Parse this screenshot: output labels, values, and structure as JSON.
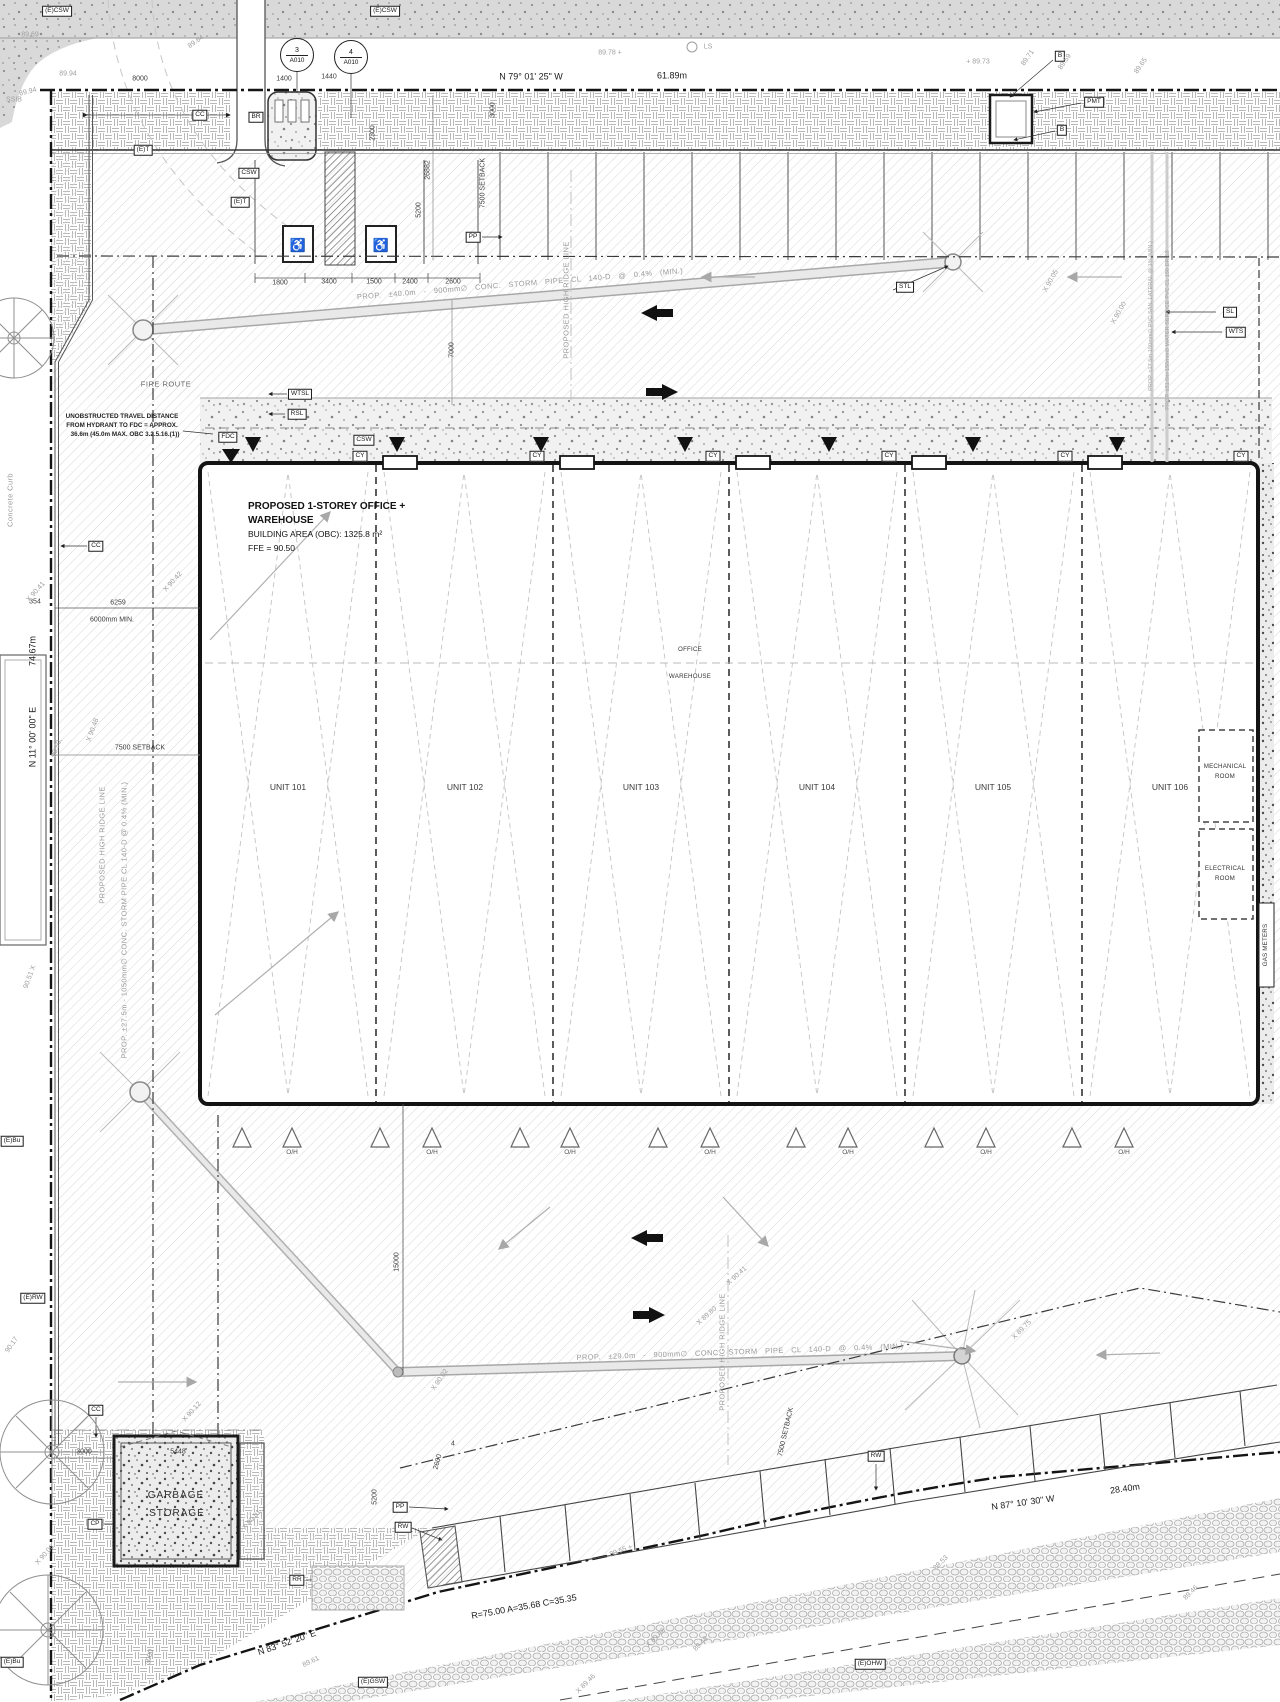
{
  "drawing": {
    "building": {
      "title_line1": "PROPOSED 1-STOREY OFFICE +",
      "title_line2": "WAREHOUSE",
      "area": "BUILDING AREA (OBC): 1325.8 m²",
      "ffe": "FFE = 90.50"
    },
    "bubbles": [
      {
        "name": "detail-bubble-3",
        "num": "3",
        "sheet": "A010",
        "x": 297,
        "y": 55
      },
      {
        "name": "detail-bubble-4",
        "num": "4",
        "sheet": "A010",
        "x": 351,
        "y": 57
      }
    ],
    "labels": [
      {
        "n": "tag-ecsw-1",
        "t": "(E)CSW",
        "x": 57,
        "y": 11,
        "c": "box"
      },
      {
        "n": "tag-ecsw-2",
        "t": "(E)CSW",
        "x": 385,
        "y": 11,
        "c": "box"
      },
      {
        "n": "tag-et-1",
        "t": "(E)T",
        "x": 143,
        "y": 150,
        "c": "box"
      },
      {
        "n": "tag-et-2",
        "t": "(E)T",
        "x": 240,
        "y": 202,
        "c": "box"
      },
      {
        "n": "tag-cc-1",
        "t": "CC",
        "x": 200,
        "y": 115,
        "c": "box"
      },
      {
        "n": "tag-br",
        "t": "BR",
        "x": 256,
        "y": 117,
        "c": "box"
      },
      {
        "n": "tag-csw-1",
        "t": "CSW",
        "x": 249,
        "y": 173,
        "c": "box"
      },
      {
        "n": "tag-cc-2",
        "t": "CC",
        "x": 96,
        "y": 546,
        "c": "box"
      },
      {
        "n": "tag-wtsl",
        "t": "WTSL",
        "x": 300,
        "y": 394,
        "c": "box"
      },
      {
        "n": "tag-rsl",
        "t": "RSL",
        "x": 297,
        "y": 414,
        "c": "box"
      },
      {
        "n": "tag-fdc",
        "t": "FDC",
        "x": 228,
        "y": 437,
        "c": "box"
      },
      {
        "n": "tag-csw-2",
        "t": "CSW",
        "x": 364,
        "y": 440,
        "c": "box"
      },
      {
        "n": "tag-pp-1",
        "t": "PP",
        "x": 473,
        "y": 237,
        "c": "box"
      },
      {
        "n": "tag-stl",
        "t": "STL",
        "x": 905,
        "y": 287,
        "c": "box"
      },
      {
        "n": "tag-sl",
        "t": "SL",
        "x": 1230,
        "y": 312,
        "c": "box"
      },
      {
        "n": "tag-wts",
        "t": "WTS",
        "x": 1236,
        "y": 332,
        "c": "box"
      },
      {
        "n": "tag-b-1",
        "t": "B",
        "x": 1060,
        "y": 56,
        "c": "box"
      },
      {
        "n": "tag-pmt",
        "t": "PMT",
        "x": 1094,
        "y": 102,
        "c": "box"
      },
      {
        "n": "tag-b-2",
        "t": "B",
        "x": 1062,
        "y": 130,
        "c": "box"
      },
      {
        "n": "tag-cy-1",
        "t": "CY",
        "x": 360,
        "y": 456,
        "c": "box"
      },
      {
        "n": "tag-cy-2",
        "t": "CY",
        "x": 537,
        "y": 456,
        "c": "box"
      },
      {
        "n": "tag-cy-3",
        "t": "CY",
        "x": 713,
        "y": 456,
        "c": "box"
      },
      {
        "n": "tag-cy-4",
        "t": "CY",
        "x": 889,
        "y": 456,
        "c": "box"
      },
      {
        "n": "tag-cy-5",
        "t": "CY",
        "x": 1065,
        "y": 456,
        "c": "box"
      },
      {
        "n": "tag-cy-6",
        "t": "CY",
        "x": 1241,
        "y": 456,
        "c": "box"
      },
      {
        "n": "tag-erw",
        "t": "(E)RW",
        "x": 33,
        "y": 1298,
        "c": "box"
      },
      {
        "n": "tag-cc-3",
        "t": "CC",
        "x": 96,
        "y": 1410,
        "c": "box"
      },
      {
        "n": "tag-cp",
        "t": "CP",
        "x": 95,
        "y": 1524,
        "c": "box"
      },
      {
        "n": "tag-rr",
        "t": "RR",
        "x": 297,
        "y": 1580,
        "c": "box"
      },
      {
        "n": "tag-pp-2",
        "t": "PP",
        "x": 400,
        "y": 1507,
        "c": "box"
      },
      {
        "n": "tag-rw-1",
        "t": "RW",
        "x": 403,
        "y": 1527,
        "c": "box"
      },
      {
        "n": "tag-rw-2",
        "t": "RW",
        "x": 876,
        "y": 1456,
        "c": "box"
      },
      {
        "n": "tag-egsw",
        "t": "(E)GSW",
        "x": 373,
        "y": 1682,
        "c": "box"
      },
      {
        "n": "tag-eohw",
        "t": "(E)OHW",
        "x": 870,
        "y": 1664,
        "c": "box"
      },
      {
        "n": "tag-ebu-1",
        "t": "(E)Bu",
        "x": 12,
        "y": 1141,
        "c": "box"
      },
      {
        "n": "tag-ebu-2",
        "t": "(E)Bu",
        "x": 12,
        "y": 1662,
        "c": "box"
      },
      {
        "n": "bearing-north",
        "t": "N 79° 01' 25\" W",
        "x": 531,
        "y": 77,
        "c": "bear"
      },
      {
        "n": "length-north",
        "t": "61.89m",
        "x": 672,
        "y": 76,
        "c": "bear"
      },
      {
        "n": "length-west",
        "t": "74.67m",
        "x": 33,
        "y": 651,
        "r": -90,
        "c": "bear"
      },
      {
        "n": "bearing-west",
        "t": "N 11° 00' 00\" E",
        "x": 33,
        "y": 737,
        "r": -90,
        "c": "bear"
      },
      {
        "n": "bearing-south",
        "t": "N 83° 52' 20\" E",
        "x": 287,
        "y": 1643,
        "r": -19,
        "c": "bear"
      },
      {
        "n": "curve-data",
        "t": "R=75.00 A=35.68 C=35.35",
        "x": 524,
        "y": 1607,
        "r": -10,
        "c": "bear"
      },
      {
        "n": "bearing-southeast",
        "t": "N 87° 10' 30\" W",
        "x": 1023,
        "y": 1503,
        "r": -8,
        "c": "bear"
      },
      {
        "n": "length-southeast",
        "t": "28.40m",
        "x": 1125,
        "y": 1489,
        "r": -8,
        "c": "bear"
      },
      {
        "n": "dim-8000",
        "t": "8000",
        "x": 140,
        "y": 79,
        "c": "dim"
      },
      {
        "n": "dim-1400",
        "t": "1400",
        "x": 284,
        "y": 79,
        "c": "dim"
      },
      {
        "n": "dim-1440",
        "t": "1440",
        "x": 329,
        "y": 77,
        "c": "dim"
      },
      {
        "n": "dim-2300",
        "t": "2300",
        "x": 373,
        "y": 133,
        "r": -90,
        "c": "dim"
      },
      {
        "n": "dim-3000-a",
        "t": "3000",
        "x": 493,
        "y": 110,
        "r": -90,
        "c": "dim"
      },
      {
        "n": "dim-26882",
        "t": "26882",
        "x": 428,
        "y": 170,
        "r": -90,
        "c": "dim"
      },
      {
        "n": "dim-5200-a",
        "t": "5200",
        "x": 419,
        "y": 210,
        "r": -90,
        "c": "dim"
      },
      {
        "n": "dim-setback-a",
        "t": "7500 SETBACK",
        "x": 483,
        "y": 183,
        "r": -90,
        "c": "dim"
      },
      {
        "n": "dim-1800",
        "t": "1800",
        "x": 280,
        "y": 283,
        "c": "dim"
      },
      {
        "n": "dim-3400",
        "t": "3400",
        "x": 329,
        "y": 282,
        "c": "dim"
      },
      {
        "n": "dim-1500",
        "t": "1500",
        "x": 374,
        "y": 282,
        "c": "dim"
      },
      {
        "n": "dim-2400",
        "t": "2400",
        "x": 410,
        "y": 282,
        "c": "dim"
      },
      {
        "n": "dim-2600-a",
        "t": "2600",
        "x": 453,
        "y": 282,
        "c": "dim"
      },
      {
        "n": "dim-7000",
        "t": "7000",
        "x": 452,
        "y": 350,
        "r": -90,
        "c": "dim"
      },
      {
        "n": "dim-354",
        "t": "354",
        "x": 35,
        "y": 602,
        "c": "dim"
      },
      {
        "n": "dim-6259",
        "t": "6259",
        "x": 118,
        "y": 603,
        "c": "dim"
      },
      {
        "n": "dim-6000",
        "t": "6000mm MIN.",
        "x": 112,
        "y": 620,
        "c": "dim"
      },
      {
        "n": "dim-setback-b",
        "t": "7500 SETBACK",
        "x": 140,
        "y": 748,
        "c": "dim"
      },
      {
        "n": "dim-15000",
        "t": "15000",
        "x": 397,
        "y": 1262,
        "r": -90,
        "c": "dim"
      },
      {
        "n": "dim-2600-b",
        "t": "2600",
        "x": 438,
        "y": 1462,
        "r": -75,
        "c": "dim"
      },
      {
        "n": "dim-4",
        "t": "4",
        "x": 453,
        "y": 1444,
        "c": "dim"
      },
      {
        "n": "dim-5200-b",
        "t": "5200",
        "x": 375,
        "y": 1497,
        "r": -90,
        "c": "dim"
      },
      {
        "n": "dim-3000-b",
        "t": "3000",
        "x": 84,
        "y": 1452,
        "c": "dim"
      },
      {
        "n": "dim-5448",
        "t": "5448",
        "x": 178,
        "y": 1452,
        "c": "dim"
      },
      {
        "n": "dim-3000-c",
        "t": "3000",
        "x": 150,
        "y": 1657,
        "r": -78,
        "c": "dimg"
      },
      {
        "n": "dim-setback-c",
        "t": "7500 SETBACK",
        "x": 786,
        "y": 1432,
        "r": -77,
        "c": "dim"
      },
      {
        "n": "spot-8969",
        "t": "89.69",
        "x": 30,
        "y": 35,
        "c": "spot"
      },
      {
        "n": "spot-8994-a",
        "t": "89.94",
        "x": 68,
        "y": 74,
        "c": "spot"
      },
      {
        "n": "spot-8994-b",
        "t": "89.94",
        "x": 28,
        "y": 92,
        "r": -15,
        "c": "spot"
      },
      {
        "n": "spot-8964",
        "t": "89.64",
        "x": 196,
        "y": 42,
        "r": -35,
        "c": "spot"
      },
      {
        "n": "spot-ssib",
        "t": "SSIB",
        "x": 14,
        "y": 100,
        "c": "spot"
      },
      {
        "n": "spot-8978",
        "t": "89.78  +",
        "x": 610,
        "y": 53,
        "c": "spot"
      },
      {
        "n": "spot-ls",
        "t": "LS",
        "x": 708,
        "y": 47,
        "c": "spot"
      },
      {
        "n": "spot-8973",
        "t": "+ 89.73",
        "x": 978,
        "y": 62,
        "c": "spot"
      },
      {
        "n": "spot-8971",
        "t": "89.71",
        "x": 1028,
        "y": 58,
        "r": -55,
        "c": "spot"
      },
      {
        "n": "spot-8959",
        "t": "89.59",
        "x": 1065,
        "y": 62,
        "r": -55,
        "c": "spot"
      },
      {
        "n": "spot-8965",
        "t": "89.65",
        "x": 1141,
        "y": 66,
        "r": -55,
        "c": "spot"
      },
      {
        "n": "spot-9041-a",
        "t": "X 90.41",
        "x": 36,
        "y": 592,
        "r": -48,
        "c": "spot"
      },
      {
        "n": "spot-9042",
        "t": "X 90.42",
        "x": 173,
        "y": 582,
        "r": -48,
        "c": "spot"
      },
      {
        "n": "spot-9048",
        "t": "X 90.48",
        "x": 93,
        "y": 730,
        "r": -70,
        "c": "spot"
      },
      {
        "n": "spot-9050",
        "t": "90.50,",
        "x": 57,
        "y": 748,
        "r": -70,
        "c": "spot"
      },
      {
        "n": "spot-9051",
        "t": "90.51 X",
        "x": 30,
        "y": 977,
        "r": -70,
        "c": "spot"
      },
      {
        "n": "spot-9017",
        "t": "90.17",
        "x": 12,
        "y": 1345,
        "r": -55,
        "c": "spot"
      },
      {
        "n": "spot-9006",
        "t": "X 90.06",
        "x": 45,
        "y": 1555,
        "r": -48,
        "c": "spot"
      },
      {
        "n": "spot-9012",
        "t": "X 90.12",
        "x": 192,
        "y": 1412,
        "r": -48,
        "c": "spot"
      },
      {
        "n": "spot-9002",
        "t": "X 90.02",
        "x": 440,
        "y": 1380,
        "r": -55,
        "c": "spot"
      },
      {
        "n": "spot-9001",
        "t": "X 90.01",
        "x": 252,
        "y": 1520,
        "r": -48,
        "c": "spot"
      },
      {
        "n": "spot-8980",
        "t": "X 89.80",
        "x": 707,
        "y": 1316,
        "r": -42,
        "c": "spot"
      },
      {
        "n": "spot-9041-b",
        "t": "X 90.41",
        "x": 737,
        "y": 1276,
        "r": -42,
        "c": "spot"
      },
      {
        "n": "spot-8975",
        "t": "X 89.75",
        "x": 1022,
        "y": 1330,
        "r": -45,
        "c": "spot"
      },
      {
        "n": "spot-9005",
        "t": "X 90.05",
        "x": 1051,
        "y": 281,
        "r": -60,
        "c": "spot"
      },
      {
        "n": "spot-9000",
        "t": "X 90.00",
        "x": 1119,
        "y": 313,
        "r": -60,
        "c": "spot"
      },
      {
        "n": "spot-8955",
        "t": "89.55 +",
        "x": 621,
        "y": 1551,
        "r": -20,
        "c": "spot"
      },
      {
        "n": "spot-8961",
        "t": "89.61",
        "x": 311,
        "y": 1662,
        "r": -25,
        "c": "spot"
      },
      {
        "n": "spot-8946-a",
        "t": "X 89.46",
        "x": 656,
        "y": 1638,
        "r": -45,
        "c": "spot"
      },
      {
        "n": "spot-8946-b",
        "t": "X 89.46",
        "x": 586,
        "y": 1684,
        "r": -45,
        "c": "spot"
      },
      {
        "n": "spot-8953",
        "t": "89.53",
        "x": 941,
        "y": 1563,
        "r": -45,
        "c": "spot"
      },
      {
        "n": "spot-8948",
        "t": "89.48",
        "x": 701,
        "y": 1644,
        "r": -45,
        "c": "spot"
      },
      {
        "n": "spot-8946-c",
        "t": "89.46",
        "x": 1191,
        "y": 1593,
        "r": -45,
        "c": "spot"
      },
      {
        "n": "note-storm-north",
        "t": "PROP. ±40.0m - 900mm∅ CONC. STORM PIPE CL 140-D @ 0.4% (MIN.)",
        "x": 520,
        "y": 284,
        "r": -4.6,
        "c": "pipew"
      },
      {
        "n": "note-ridge-north",
        "t": "PROPOSED HIGH RIDGE LINE",
        "x": 566,
        "y": 300,
        "r": -90,
        "c": "pipe"
      },
      {
        "n": "note-ridge-south",
        "t": "PROPOSED HIGH RIDGE LINE",
        "x": 722,
        "y": 1352,
        "r": -90,
        "c": "pipe"
      },
      {
        "n": "note-ridge-west",
        "t": "PROPOSED HIGH RIDGE LINE",
        "x": 102,
        "y": 845,
        "r": -90,
        "c": "pipe"
      },
      {
        "n": "note-storm-south",
        "t": "PROP. ±29.0m - 900mm∅ CONC. STORM PIPE CL 140-D @ 0.4% (MIN.)",
        "x": 740,
        "y": 1352,
        "r": -2,
        "c": "pipew"
      },
      {
        "n": "note-storm-west",
        "t": "PROP. ±27.5m - 1050mm∅ CONC. STORM PIPE CL 140-D @ 0.4% (MIN.)",
        "x": 124,
        "y": 920,
        "r": -90,
        "c": "pipe"
      },
      {
        "n": "note-san-lateral",
        "t": "PROP. ±17.5m-150mm∅ PVC SAN. LATERAL @ 1% (MIN.)",
        "x": 1152,
        "y": 316,
        "r": -90,
        "c": "vsmall"
      },
      {
        "n": "note-water-service",
        "t": "PROP. ±31.0m-150mm∅ WATER SERVICE PVC CL 150 DR-18",
        "x": 1169,
        "y": 330,
        "r": -90,
        "c": "vsmall"
      },
      {
        "n": "note-concrete-curb",
        "t": "Concrete Curb",
        "x": 10,
        "y": 500,
        "r": -90,
        "c": "pipe"
      },
      {
        "n": "note-fire-route",
        "t": "FIRE ROUTE",
        "x": 166,
        "y": 384,
        "c": "frt"
      },
      {
        "n": "note-hydrant-1",
        "t": "UNOBSTRUCTED TRAVEL DISTANCE",
        "x": 122,
        "y": 417,
        "c": "note"
      },
      {
        "n": "note-hydrant-2",
        "t": "FROM HYDRANT TO FDC = APPROX.",
        "x": 122,
        "y": 426,
        "c": "note"
      },
      {
        "n": "note-hydrant-3",
        "t": "36.6m (45.0m MAX. OBC 3.2.5.16.(1))",
        "x": 125,
        "y": 435,
        "c": "note"
      },
      {
        "n": "room-office",
        "t": "OFFICE",
        "x": 690,
        "y": 650,
        "c": "room"
      },
      {
        "n": "room-warehouse",
        "t": "WAREHOUSE",
        "x": 690,
        "y": 677,
        "c": "room"
      },
      {
        "n": "unit-101",
        "t": "UNIT 101",
        "x": 288,
        "y": 787,
        "c": "unit"
      },
      {
        "n": "unit-102",
        "t": "UNIT 102",
        "x": 465,
        "y": 787,
        "c": "unit"
      },
      {
        "n": "unit-103",
        "t": "UNIT 103",
        "x": 641,
        "y": 787,
        "c": "unit"
      },
      {
        "n": "unit-104",
        "t": "UNIT 104",
        "x": 817,
        "y": 787,
        "c": "unit"
      },
      {
        "n": "unit-105",
        "t": "UNIT 105",
        "x": 993,
        "y": 787,
        "c": "unit"
      },
      {
        "n": "unit-106",
        "t": "UNIT 106",
        "x": 1170,
        "y": 787,
        "c": "unit"
      },
      {
        "n": "room-mech-1",
        "t": "MECHANICAL",
        "x": 1225,
        "y": 767,
        "c": "room"
      },
      {
        "n": "room-mech-2",
        "t": "ROOM",
        "x": 1225,
        "y": 777,
        "c": "room"
      },
      {
        "n": "room-elec-1",
        "t": "ELECTRICAL",
        "x": 1225,
        "y": 869,
        "c": "room"
      },
      {
        "n": "room-elec-2",
        "t": "ROOM",
        "x": 1225,
        "y": 879,
        "c": "room"
      },
      {
        "n": "room-gas-meters",
        "t": "GAS METERS",
        "x": 1266,
        "y": 945,
        "r": -90,
        "c": "room"
      },
      {
        "n": "garbage-1",
        "t": "GARBAGE",
        "x": 176,
        "y": 1496,
        "c": "big"
      },
      {
        "n": "garbage-2",
        "t": "STORAGE",
        "x": 177,
        "y": 1514,
        "c": "big"
      },
      {
        "n": "oh-1",
        "t": "O/H",
        "x": 292,
        "y": 1153,
        "c": "oh"
      },
      {
        "n": "oh-2",
        "t": "O/H",
        "x": 432,
        "y": 1153,
        "c": "oh"
      },
      {
        "n": "oh-3",
        "t": "O/H",
        "x": 570,
        "y": 1153,
        "c": "oh"
      },
      {
        "n": "oh-4",
        "t": "O/H",
        "x": 710,
        "y": 1153,
        "c": "oh"
      },
      {
        "n": "oh-5",
        "t": "O/H",
        "x": 848,
        "y": 1153,
        "c": "oh"
      },
      {
        "n": "oh-6",
        "t": "O/H",
        "x": 986,
        "y": 1153,
        "c": "oh"
      },
      {
        "n": "oh-7",
        "t": "O/H",
        "x": 1124,
        "y": 1153,
        "c": "oh"
      },
      {
        "n": "accessible-parking-icon",
        "t": "♿",
        "x": 298,
        "y": 245,
        "c": "acc"
      },
      {
        "n": "accessible-parking-icon",
        "t": "♿",
        "x": 381,
        "y": 245,
        "c": "acc"
      }
    ]
  }
}
